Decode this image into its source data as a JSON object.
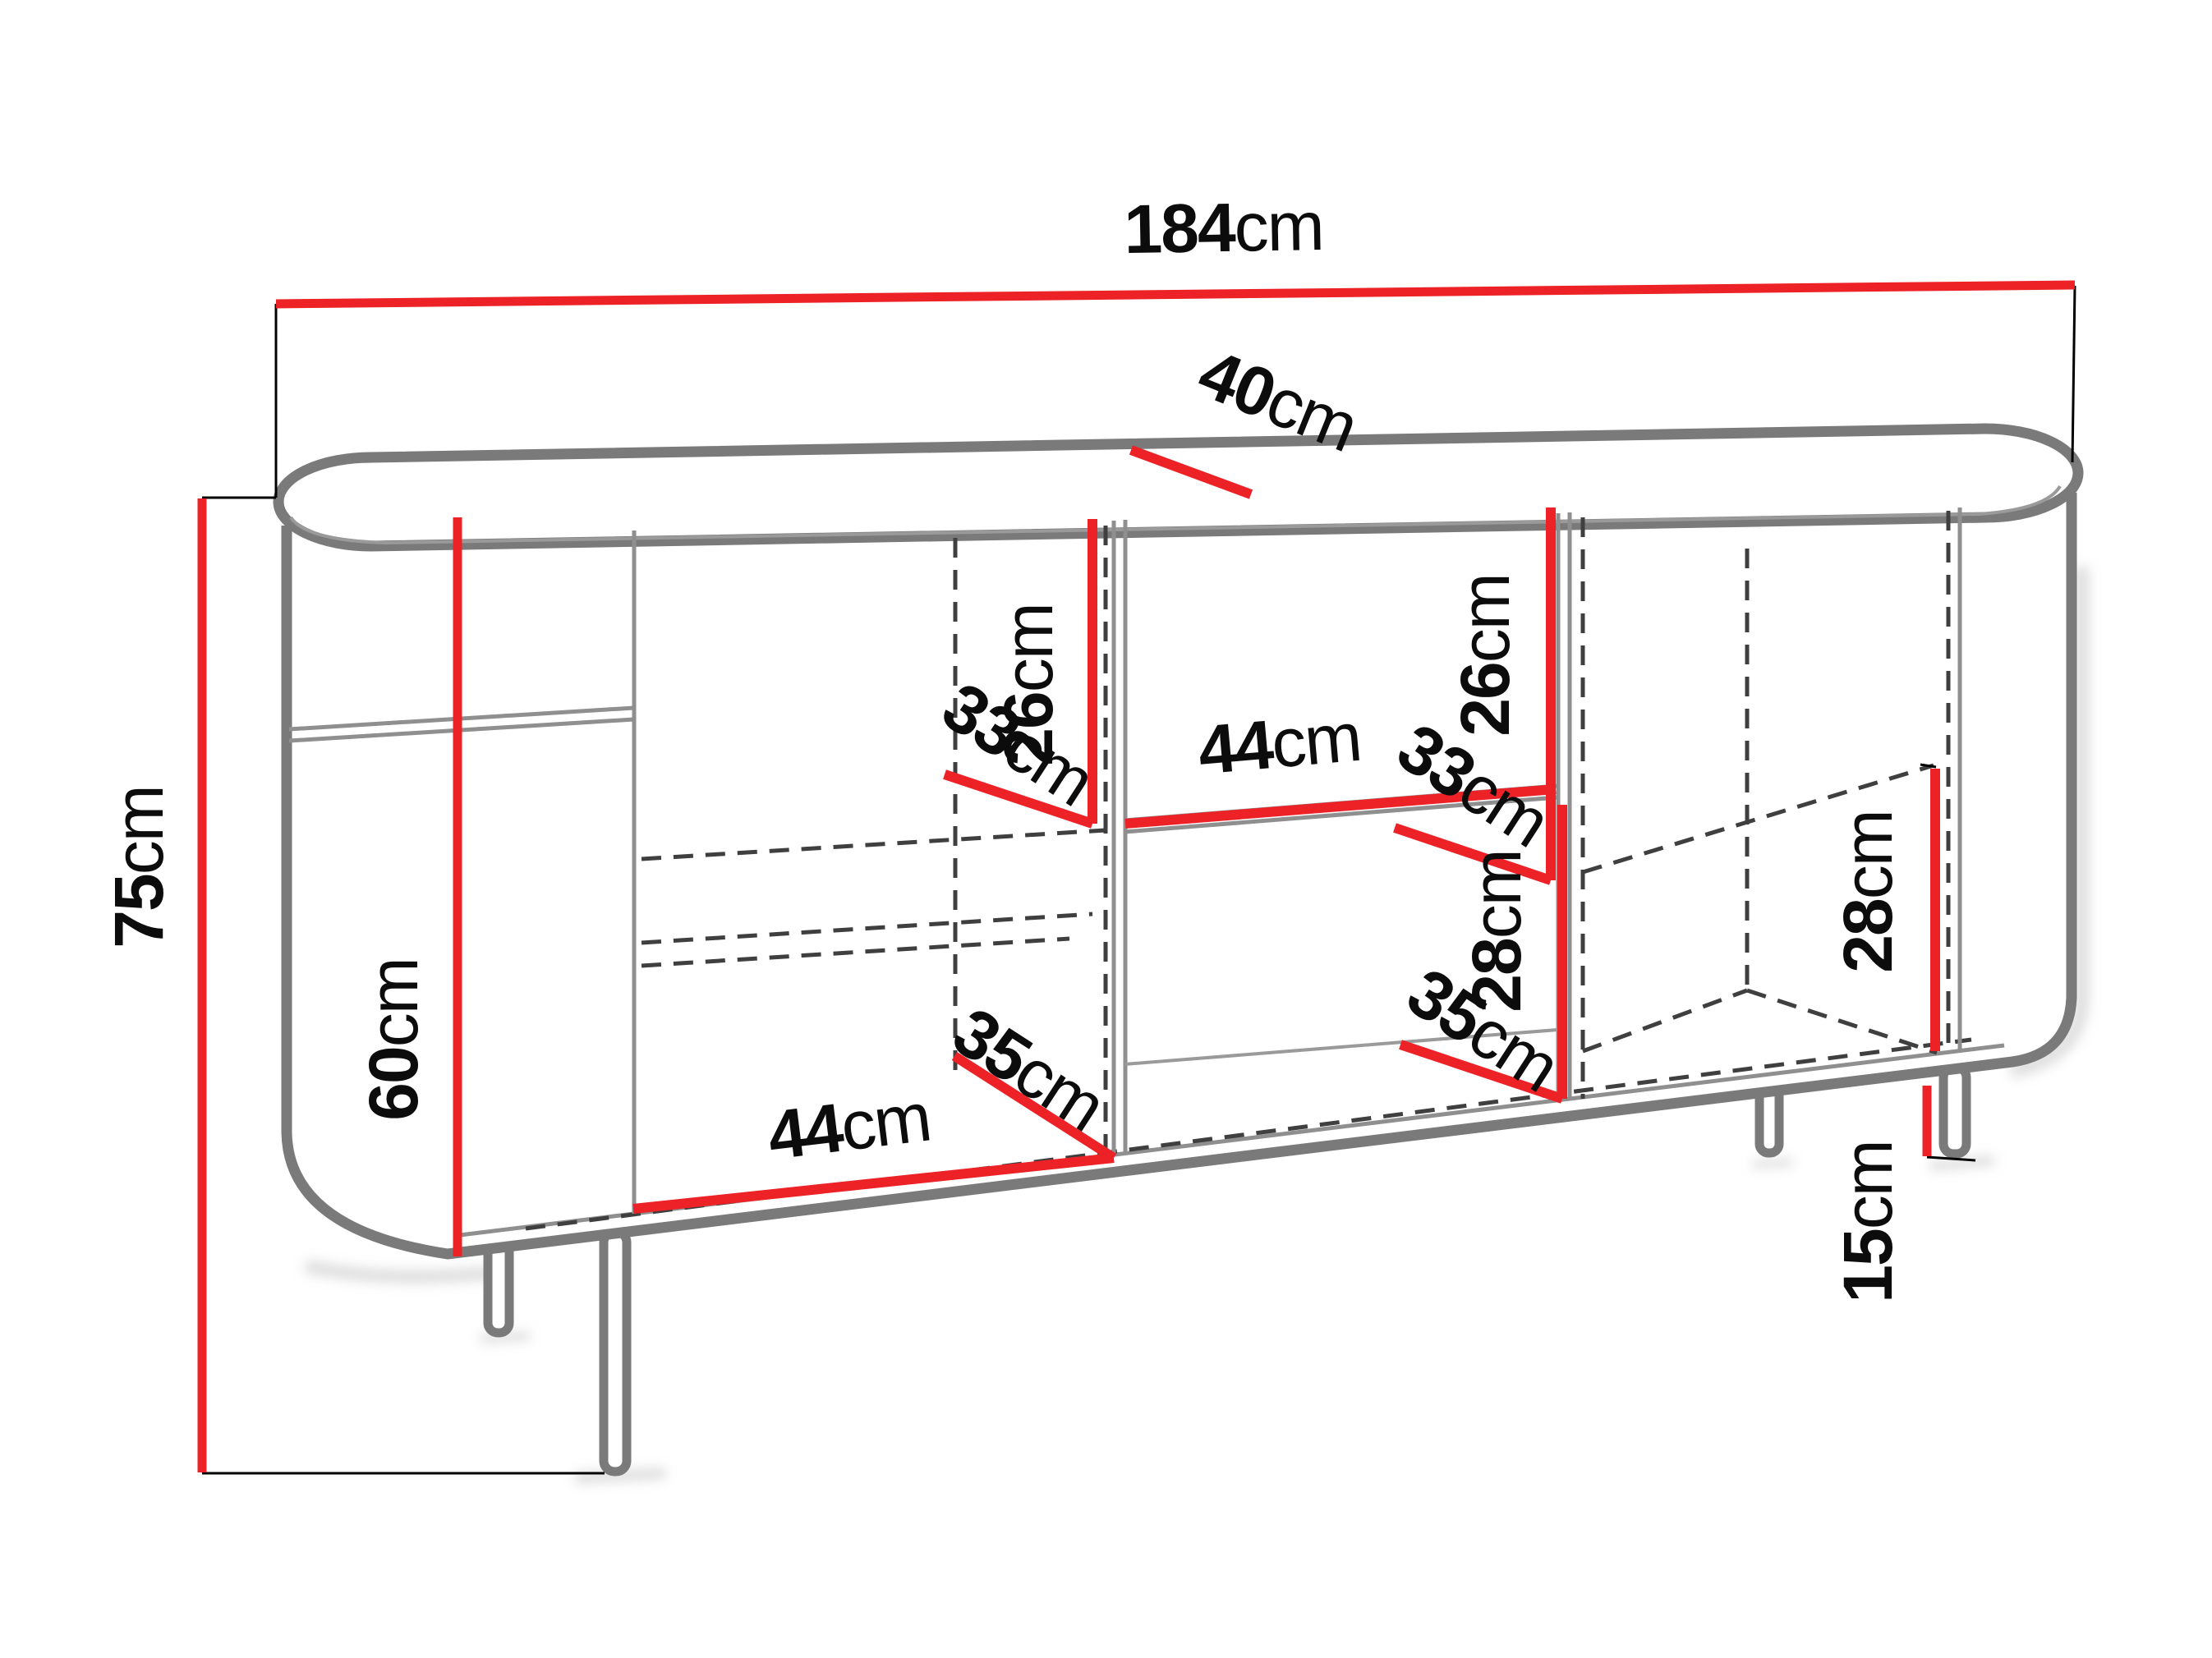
{
  "figure": {
    "type": "furniture-dimension-diagram",
    "subject": "sideboard cabinet with rounded ends, open shelves and metal legs",
    "background": "#ffffff"
  },
  "colors": {
    "accent-red": "#ec2227",
    "outline-gray": "#7a7a7a",
    "thin-gray": "#8f8f8f",
    "dash-gray": "#3f3f3f",
    "text-black": "#0c0c0c",
    "bg": "#ffffff"
  },
  "dims": {
    "width": {
      "value": "184",
      "unit": "cm"
    },
    "depth": {
      "value": "40",
      "unit": "cm"
    },
    "height": {
      "value": "75",
      "unit": "cm"
    },
    "interior_height": {
      "value": "60",
      "unit": "cm"
    },
    "left_cubby_height": {
      "value": "26",
      "unit": "cm"
    },
    "left_cubby_depth": {
      "value": "33",
      "unit": "cm"
    },
    "middle_shelf_width": {
      "value": "44",
      "unit": "cm"
    },
    "right_cubby_height": {
      "value": "26",
      "unit": "cm"
    },
    "right_cubby_depth": {
      "value": "33",
      "unit": "cm"
    },
    "middle_lower_height": {
      "value": "28",
      "unit": "cm"
    },
    "middle_lower_depth": {
      "value": "35",
      "unit": "cm"
    },
    "bottom_left_width": {
      "value": "44",
      "unit": "cm"
    },
    "bottom_left_depth": {
      "value": "35",
      "unit": "cm"
    },
    "right_lower_height": {
      "value": "28",
      "unit": "cm"
    },
    "leg_height": {
      "value": "15",
      "unit": "cm"
    }
  }
}
